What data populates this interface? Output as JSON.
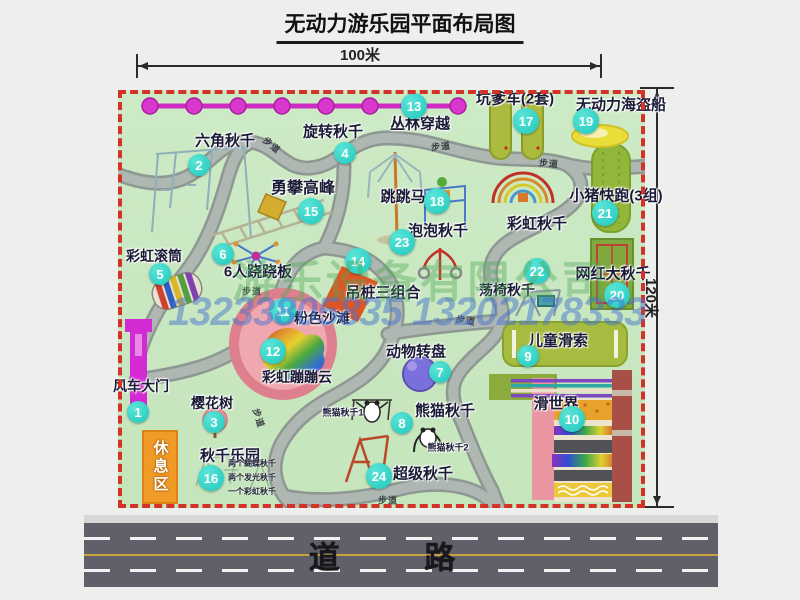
{
  "title": "无动力游乐园平面布局图",
  "dimensions": {
    "width": "100米",
    "height": "120米"
  },
  "road_label": "道 路",
  "rest_area": "休息区",
  "trail_label": "步道",
  "watermarks": {
    "company": "游乐设备有限公司",
    "phones": "13233805835 13202178333"
  },
  "attractions": [
    {
      "num": "1",
      "label": "风车大门",
      "lx": 23,
      "ly": 296,
      "bx": 20,
      "by": 322,
      "fs": 14
    },
    {
      "num": "2",
      "label": "六角秋千",
      "lx": 107,
      "ly": 50,
      "bx": 81,
      "by": 75,
      "fs": 15
    },
    {
      "num": "3",
      "label": "樱花树",
      "lx": 94,
      "ly": 313,
      "bx": 96,
      "by": 332,
      "fs": 14
    },
    {
      "num": "4",
      "label": "旋转秋千",
      "lx": 215,
      "ly": 41,
      "bx": 227,
      "by": 63,
      "fs": 15
    },
    {
      "num": "5",
      "label": "彩虹滚筒",
      "lx": 36,
      "ly": 166,
      "bx": 42,
      "by": 184,
      "fs": 14
    },
    {
      "num": "6",
      "label": "6人跷跷板",
      "lx": 140,
      "ly": 181,
      "bx": 105,
      "by": 164,
      "fs": 15
    },
    {
      "num": "7",
      "label": "动物转盘",
      "lx": 298,
      "ly": 261,
      "bx": 322,
      "by": 282,
      "fs": 15
    },
    {
      "num": "8",
      "label": "熊猫秋千",
      "lx": 327,
      "ly": 320,
      "bx": 284,
      "by": 333,
      "fs": 15
    },
    {
      "num": "9",
      "label": "儿童滑索",
      "lx": 440,
      "ly": 250,
      "bx": 410,
      "by": 266,
      "fs": 15
    },
    {
      "num": "10",
      "label": "滑世界",
      "lx": 438,
      "ly": 313,
      "bx": 454,
      "by": 329,
      "fs": 15
    },
    {
      "num": "11",
      "label": "粉色沙滩",
      "lx": 204,
      "ly": 228,
      "bx": 165,
      "by": 221,
      "fs": 14
    },
    {
      "num": "12",
      "label": "彩虹蹦蹦云",
      "lx": 179,
      "ly": 287,
      "bx": 155,
      "by": 261,
      "fs": 14
    },
    {
      "num": "13",
      "label": "丛林穿越",
      "lx": 302,
      "ly": 33,
      "bx": 296,
      "by": 16,
      "fs": 15
    },
    {
      "num": "14",
      "label": "吊桩三组合",
      "lx": 265,
      "ly": 202,
      "bx": 240,
      "by": 171,
      "fs": 15
    },
    {
      "num": "15",
      "label": "勇攀高峰",
      "lx": 185,
      "ly": 96,
      "bx": 193,
      "by": 121,
      "fs": 16
    },
    {
      "num": "16",
      "label": "秋千乐园",
      "lx": 112,
      "ly": 365,
      "bx": 93,
      "by": 388,
      "fs": 15
    },
    {
      "num": "17",
      "label": "坑爹车(2套)",
      "lx": 397,
      "ly": 8,
      "bx": 408,
      "by": 31,
      "fs": 15
    },
    {
      "num": "18",
      "label": "跳跳马",
      "lx": 285,
      "ly": 106,
      "bx": 319,
      "by": 111,
      "fs": 15
    },
    {
      "num": "19",
      "label": "无动力海盗船",
      "lx": 503,
      "ly": 14,
      "bx": 468,
      "by": 31,
      "fs": 15
    },
    {
      "num": "20",
      "label": "网红大秋千",
      "lx": 495,
      "ly": 183,
      "bx": 499,
      "by": 205,
      "fs": 15
    },
    {
      "num": "21",
      "label": "小猪快跑(3组)",
      "lx": 498,
      "ly": 105,
      "bx": 487,
      "by": 123,
      "fs": 15
    },
    {
      "num": "22",
      "label": "荡椅秋千",
      "lx": 389,
      "ly": 200,
      "bx": 419,
      "by": 181,
      "fs": 14
    },
    {
      "num": "23",
      "label": "泡泡秋千",
      "lx": 320,
      "ly": 140,
      "bx": 284,
      "by": 152,
      "fs": 15
    },
    {
      "num": "24",
      "label": "超级秋千",
      "lx": 305,
      "ly": 383,
      "bx": 261,
      "by": 386,
      "fs": 15
    },
    {
      "num": "",
      "label": "彩虹秋千",
      "lx": 419,
      "ly": 133,
      "fs": 15
    },
    {
      "num": "",
      "label": "熊猫秋千1",
      "lx": 225,
      "ly": 322,
      "fs": 9
    },
    {
      "num": "",
      "label": "熊猫秋千2",
      "lx": 330,
      "ly": 357,
      "fs": 9
    }
  ],
  "swing_park_notes": [
    "两个蝴蝶秋千",
    "两个发光秋千",
    "一个彩虹秋千"
  ],
  "trail_labels": [
    {
      "x": 154,
      "y": 55,
      "rot": 40
    },
    {
      "x": 323,
      "y": 56,
      "rot": -5
    },
    {
      "x": 431,
      "y": 73,
      "rot": 5
    },
    {
      "x": 134,
      "y": 201,
      "rot": 0
    },
    {
      "x": 348,
      "y": 230,
      "rot": 10
    },
    {
      "x": 141,
      "y": 328,
      "rot": 72
    },
    {
      "x": 270,
      "y": 410,
      "rot": 0
    }
  ],
  "colors": {
    "border_red": "#d23228",
    "badge_teal": "#2fd6ca",
    "park_green": "#c9e8c2",
    "zipline_magenta": "#d02cc4",
    "road_gray": "#60606a",
    "gate_magenta": "#d42ad4",
    "rest_orange": "#f09b28"
  }
}
